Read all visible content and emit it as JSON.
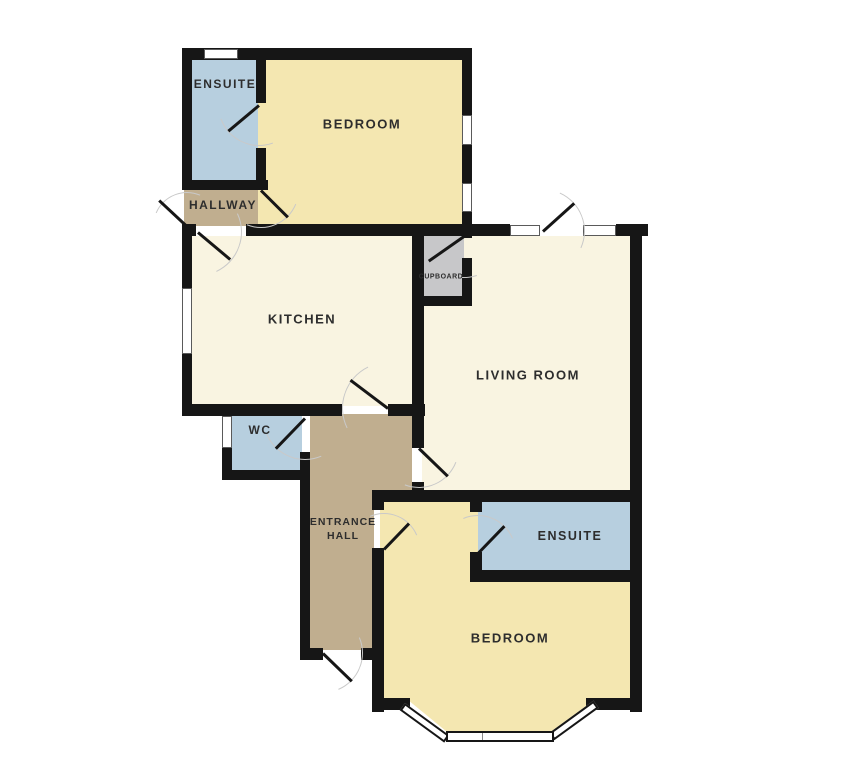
{
  "title": "Apartment floor plan",
  "colors": {
    "wall": "#161616",
    "bath_blue": "#b7cfdf",
    "bedroom_yellow": "#f4e7b1",
    "kitchen_cream": "#f9f4e1",
    "hall_brown": "#c0ae8f",
    "cupboard_grey": "#c7c7c9",
    "window_white": "#ffffff",
    "window_edge": "#5a5a5a",
    "door_arc": "#c9c9c9",
    "label_text": "#2d2d2d",
    "background": "#ffffff"
  },
  "rooms": {
    "ensuite_top": {
      "label": "ENSUITE"
    },
    "bedroom_top": {
      "label": "BEDROOM"
    },
    "hallway": {
      "label": "HALLWAY"
    },
    "kitchen": {
      "label": "KITCHEN"
    },
    "cupboard": {
      "label": "CUPBOARD"
    },
    "living_room": {
      "label": "LIVING ROOM"
    },
    "wc": {
      "label": "WC"
    },
    "entrance_hall": {
      "label_line1": "ENTRANCE",
      "label_line2": "HALL"
    },
    "ensuite_bottom": {
      "label": "ENSUITE"
    },
    "bedroom_bottom": {
      "label": "BEDROOM"
    }
  }
}
